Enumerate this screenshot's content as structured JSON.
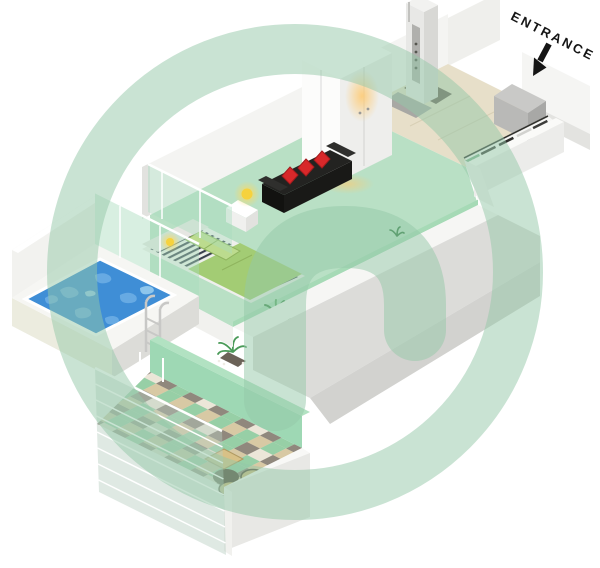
{
  "page": {
    "width": 600,
    "height": 568,
    "background": "#ffffff",
    "description": "Isometric 3D floor plan of a studio apartment with private pool and balcony"
  },
  "labels": {
    "entrance": "ENTRANCE"
  },
  "palette": {
    "watermark_green": "#93c7a8",
    "floor_green": "#b9e0c5",
    "hall_floor_beige": "#e7dfc9",
    "pool_blue": "#3f8ed6",
    "pool_ripple": "#6fb0e6",
    "sofa_black": "#232321",
    "pillow_red": "#d8282a",
    "duvet_green": "#a3cc74",
    "pillow_green": "#bcdb8e",
    "lamp_yellow": "#f6d23e",
    "mint_glass": "#a8dcbd",
    "mint_wall": "#9ed8b4",
    "checker_mint": "#97cfa6",
    "checker_tan": "#d8c9a4",
    "checker_gray": "#90887d",
    "checker_cream": "#ece6d8",
    "wall_white": "#f4f4f2",
    "wall_shadow": "#d9d9d6",
    "outdoor_wood": "#d8c187",
    "plant_green": "#3d8a4b"
  },
  "features": [
    "entrance",
    "entry-hallway-with-kitchen",
    "kitchen-appliances",
    "entry-door-pivot",
    "wardrobe",
    "living-area",
    "sofa-with-red-cushions",
    "side-table-with-lamp",
    "bed-with-striped-linen",
    "plants",
    "swimming-pool",
    "pool-ladder",
    "glass-partitions",
    "balcony-checkered-terrace",
    "outdoor-table-and-seats",
    "glass-railing",
    "developer-watermark-logo"
  ]
}
